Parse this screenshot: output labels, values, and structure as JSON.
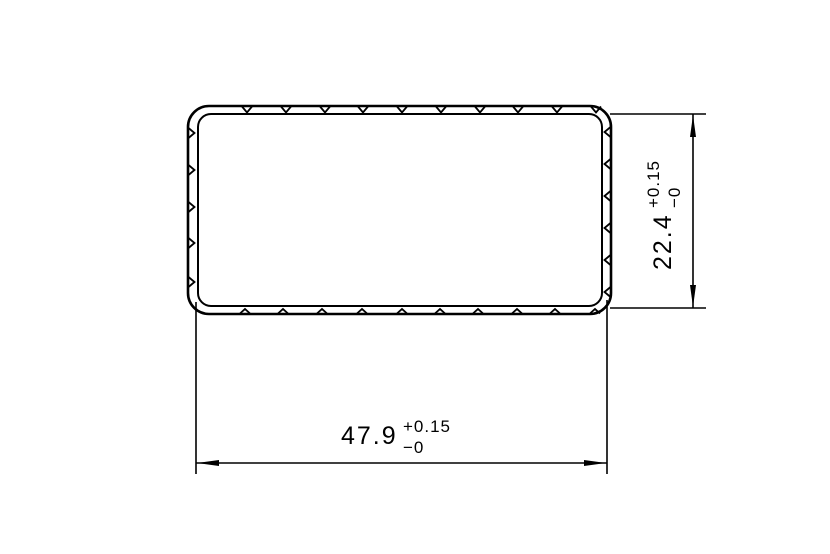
{
  "colors": {
    "line": "#000000",
    "background": "#ffffff"
  },
  "drawing": {
    "kind": "extrusion-profile-cross-section",
    "dimensions": {
      "width": {
        "value": "47.9",
        "tolerance_plus": "+0.15",
        "tolerance_minus": "−0"
      },
      "height": {
        "value": "22.4",
        "tolerance_plus": "+0.15",
        "tolerance_minus": "−0"
      }
    }
  }
}
